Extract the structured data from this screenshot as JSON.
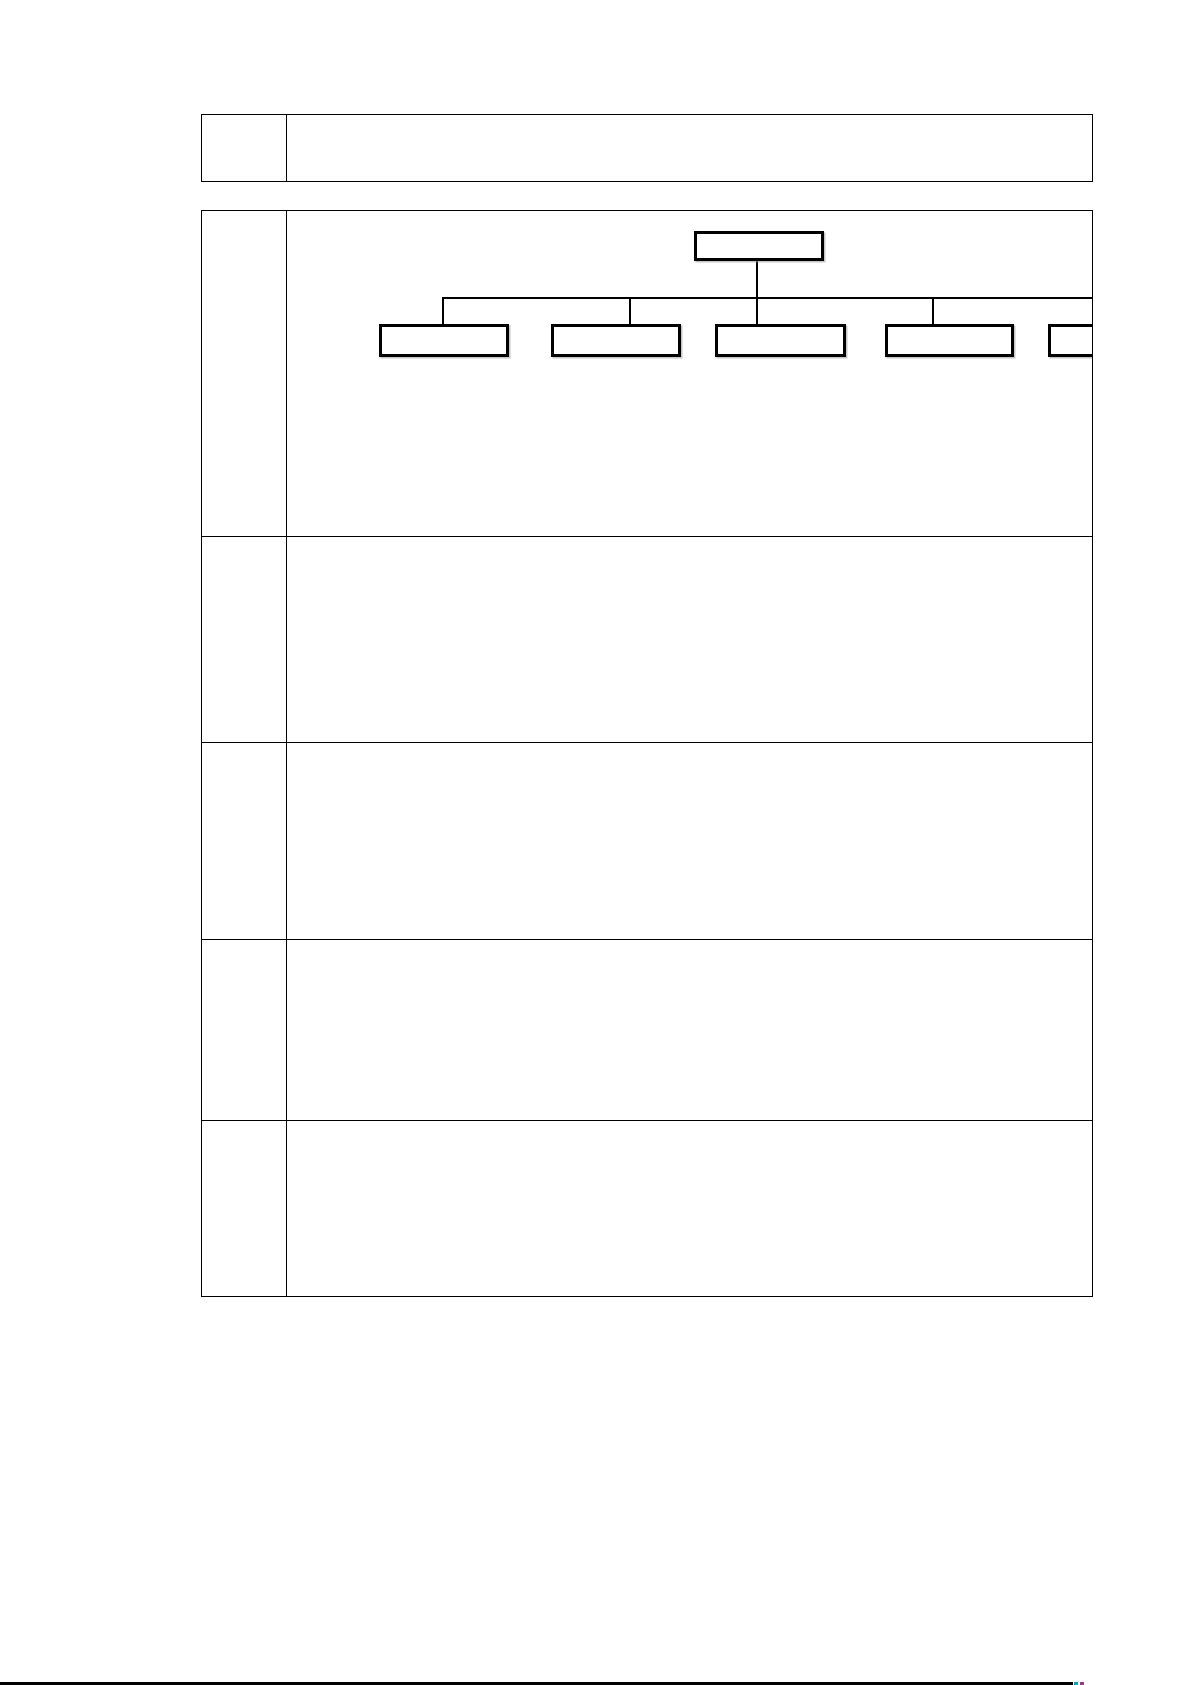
{
  "document": {
    "background_color": "#ffffff",
    "line_color": "#000000"
  },
  "header_table": {
    "rows": [
      {
        "cells": [
          {
            "text": ""
          },
          {
            "text": ""
          }
        ]
      }
    ]
  },
  "main_table": {
    "rows": [
      {
        "cells": [
          {
            "text": ""
          },
          {
            "text": ""
          }
        ]
      },
      {
        "cells": [
          {
            "text": ""
          },
          {
            "text": ""
          }
        ]
      },
      {
        "cells": [
          {
            "text": ""
          },
          {
            "text": ""
          }
        ]
      },
      {
        "cells": [
          {
            "text": ""
          },
          {
            "text": ""
          }
        ]
      },
      {
        "cells": [
          {
            "text": ""
          },
          {
            "text": ""
          }
        ]
      }
    ]
  },
  "org_chart": {
    "type": "org-chart",
    "root": {
      "label": ""
    },
    "children": [
      {
        "label": ""
      },
      {
        "label": ""
      },
      {
        "label": ""
      },
      {
        "label": ""
      },
      {
        "label": ""
      }
    ],
    "box_border_color": "#000000",
    "connector_color": "#000000"
  },
  "bottom_rule": {
    "color": "#000000",
    "accents": [
      {
        "name": "cyan-dash",
        "color": "#00a5c8"
      },
      {
        "name": "purple-dash",
        "color": "#8e3a8e"
      }
    ]
  }
}
